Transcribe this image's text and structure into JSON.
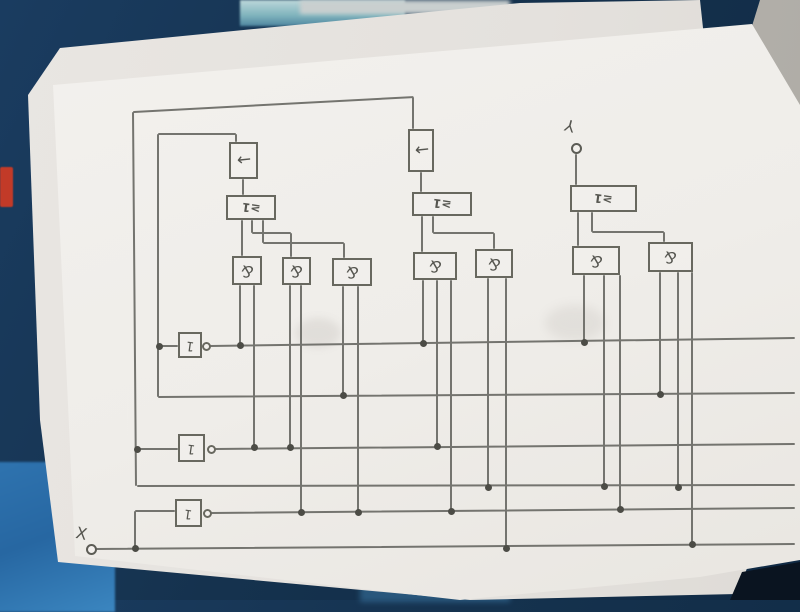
{
  "scene": {
    "description": "photo of a pencil hand-drawn sequential logic circuit on white paper lying on a dark blue cloth",
    "cloth_color": "#15324e",
    "cloth_bright_corner": "#2f74b0",
    "teal_patch": "#7fb3bd",
    "gray_object_top_right": "#b7b4ae",
    "red_thread": "#c23a28",
    "black_patch_bottom_right": "#0a1420",
    "back_paper": "#e7e4e0",
    "front_paper": "#f0eeea",
    "pencil_color": "#74746f"
  },
  "diagram": {
    "type": "hand-drawn logic circuit (drawn upside-down relative to photo)",
    "symbols": {
      "ff": "←",
      "or": "≥1",
      "and": "&",
      "not": "1"
    },
    "terminals": [
      {
        "label": "X",
        "cx": 91,
        "cy": 549,
        "lx": 76,
        "ly": 524,
        "rot": 12
      },
      {
        "label": "Y",
        "cx": 576,
        "cy": 148,
        "lx": 565,
        "ly": 116,
        "rot": 195
      }
    ],
    "boxes": [
      {
        "type": "ff",
        "x": 229,
        "y": 142,
        "w": 29,
        "h": 37
      },
      {
        "type": "ff",
        "x": 408,
        "y": 129,
        "w": 26,
        "h": 43
      },
      {
        "type": "or",
        "x": 226,
        "y": 195,
        "w": 50,
        "h": 25
      },
      {
        "type": "or",
        "x": 412,
        "y": 192,
        "w": 60,
        "h": 24
      },
      {
        "type": "or",
        "x": 570,
        "y": 185,
        "w": 67,
        "h": 27
      },
      {
        "type": "and",
        "x": 232,
        "y": 256,
        "w": 30,
        "h": 29
      },
      {
        "type": "and",
        "x": 282,
        "y": 257,
        "w": 29,
        "h": 28
      },
      {
        "type": "and",
        "x": 332,
        "y": 258,
        "w": 40,
        "h": 28
      },
      {
        "type": "and",
        "x": 413,
        "y": 252,
        "w": 44,
        "h": 28
      },
      {
        "type": "and",
        "x": 475,
        "y": 249,
        "w": 38,
        "h": 29
      },
      {
        "type": "and",
        "x": 572,
        "y": 246,
        "w": 48,
        "h": 29
      },
      {
        "type": "and",
        "x": 648,
        "y": 242,
        "w": 45,
        "h": 30
      },
      {
        "type": "not",
        "x": 178,
        "y": 332,
        "w": 24,
        "h": 26
      },
      {
        "type": "not",
        "x": 178,
        "y": 434,
        "w": 27,
        "h": 28
      },
      {
        "type": "not",
        "x": 175,
        "y": 499,
        "w": 27,
        "h": 28
      }
    ],
    "bubbles": [
      [
        206,
        346
      ],
      [
        211,
        449
      ],
      [
        207,
        513
      ]
    ],
    "segments": [
      [
        133,
        112,
        414,
        97
      ],
      [
        158,
        134,
        236,
        134
      ],
      [
        236,
        134,
        236,
        142
      ],
      [
        133,
        112,
        136,
        486
      ],
      [
        137,
        486,
        795,
        485
      ],
      [
        158,
        134,
        158,
        397
      ],
      [
        158,
        397,
        795,
        393
      ],
      [
        159,
        346,
        178,
        346
      ],
      [
        137,
        449,
        178,
        449
      ],
      [
        210,
        346,
        795,
        338
      ],
      [
        215,
        449,
        795,
        444
      ],
      [
        211,
        513,
        795,
        508
      ],
      [
        96,
        549,
        795,
        544
      ],
      [
        135,
        548,
        135,
        511
      ],
      [
        135,
        511,
        175,
        511
      ],
      [
        243,
        179,
        243,
        195
      ],
      [
        242,
        220,
        242,
        256
      ],
      [
        252,
        220,
        252,
        233
      ],
      [
        252,
        233,
        291,
        233
      ],
      [
        291,
        233,
        291,
        257
      ],
      [
        263,
        220,
        263,
        243
      ],
      [
        263,
        243,
        344,
        243
      ],
      [
        344,
        243,
        344,
        258
      ],
      [
        413,
        97,
        413,
        129
      ],
      [
        421,
        172,
        421,
        192
      ],
      [
        422,
        216,
        422,
        252
      ],
      [
        433,
        216,
        433,
        233
      ],
      [
        433,
        233,
        494,
        233
      ],
      [
        494,
        233,
        494,
        249
      ],
      [
        576,
        154,
        576,
        185
      ],
      [
        578,
        212,
        578,
        246
      ],
      [
        592,
        212,
        592,
        232
      ],
      [
        592,
        232,
        664,
        232
      ],
      [
        664,
        232,
        664,
        242
      ],
      [
        240,
        285,
        240,
        345
      ],
      [
        254,
        285,
        254,
        447
      ],
      [
        290,
        285,
        290,
        447
      ],
      [
        301,
        285,
        301,
        512
      ],
      [
        343,
        286,
        343,
        395
      ],
      [
        358,
        286,
        358,
        512
      ],
      [
        423,
        280,
        423,
        343
      ],
      [
        437,
        280,
        437,
        446
      ],
      [
        451,
        280,
        451,
        511
      ],
      [
        488,
        278,
        488,
        487
      ],
      [
        506,
        278,
        506,
        548
      ],
      [
        584,
        275,
        584,
        342
      ],
      [
        604,
        275,
        604,
        486
      ],
      [
        620,
        275,
        620,
        509
      ],
      [
        660,
        272,
        660,
        394
      ],
      [
        678,
        272,
        678,
        487
      ],
      [
        692,
        272,
        692,
        544
      ]
    ],
    "dots": [
      [
        240,
        345
      ],
      [
        254,
        447
      ],
      [
        290,
        447
      ],
      [
        301,
        512
      ],
      [
        343,
        395
      ],
      [
        358,
        512
      ],
      [
        423,
        343
      ],
      [
        437,
        446
      ],
      [
        451,
        511
      ],
      [
        488,
        487
      ],
      [
        506,
        548
      ],
      [
        584,
        342
      ],
      [
        604,
        486
      ],
      [
        620,
        509
      ],
      [
        660,
        394
      ],
      [
        678,
        487
      ],
      [
        692,
        544
      ],
      [
        159,
        346
      ],
      [
        137,
        449
      ],
      [
        135,
        548
      ]
    ]
  }
}
